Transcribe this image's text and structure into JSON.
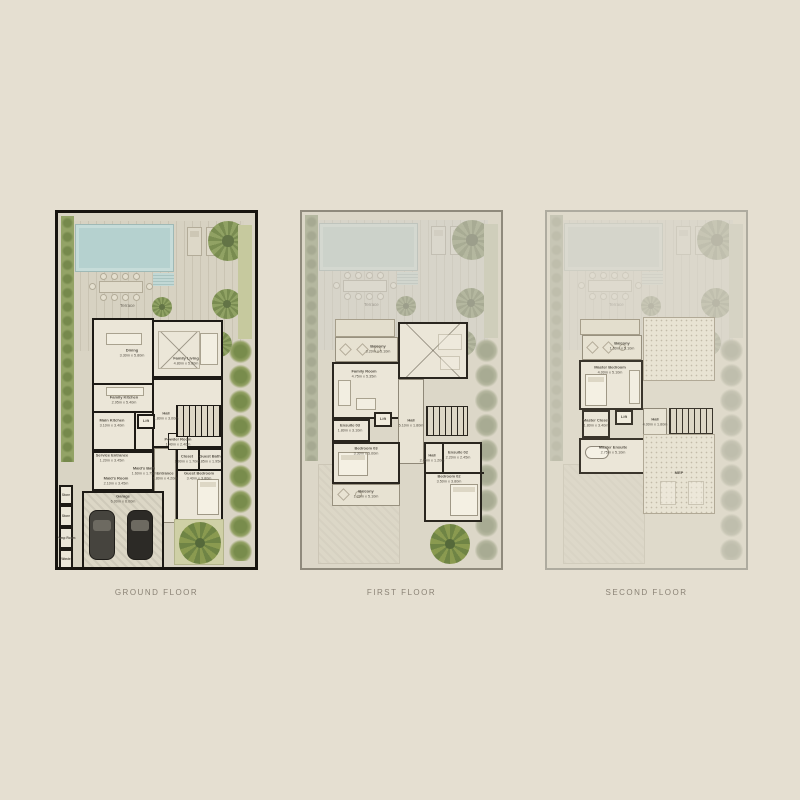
{
  "background": "#e5dfd1",
  "captions": {
    "ground": "GROUND FLOOR",
    "first": "FIRST FLOOR",
    "second": "SECOND FLOOR"
  },
  "shared": {
    "terrace_label": "Terrace"
  },
  "colors": {
    "page_background": "#e5dfd1",
    "pool": "#b5d1cf",
    "hedge_green": "#8ea064",
    "wall_dark": "#1d1a15",
    "caption_text": "#8b8376"
  },
  "plans": {
    "ground": {
      "rooms": {
        "dining": {
          "name": "Dining",
          "dims": "3.30m x 5.80m"
        },
        "familyLiving": {
          "name": "Family Living",
          "dims": "4.80m x 5.80m"
        },
        "familyKitchen": {
          "name": "Family Kitchen",
          "dims": "2.95m x 5.40m"
        },
        "mainKitchen": {
          "name": "Main Kitchen",
          "dims": "3.10m x 3.40m"
        },
        "lift": {
          "name": "Lift"
        },
        "hall": {
          "name": "Hall",
          "dims": "1.80m x 3.00m"
        },
        "powderRoom": {
          "name": "Powder Room",
          "dims": "1.40m x 2.40m"
        },
        "serviceEntrance": {
          "name": "Service Entrance",
          "dims": "1.20m x 3.45m"
        },
        "maidsBath": {
          "name": "Maid's Bath",
          "dims": "1.60m x 1.75m"
        },
        "maidsRoom": {
          "name": "Maid's Room",
          "dims": "2.10m x 3.45m"
        },
        "entrance": {
          "name": "Entrance",
          "dims": "1.80m x 4.20m"
        },
        "closet": {
          "name": "Closet",
          "dims": "1.90m x 1.70m"
        },
        "guestBath": {
          "name": "Guest Bath",
          "dims": "1.85m x 1.95m"
        },
        "guestBedroom": {
          "name": "Guest Bedroom",
          "dims": "3.40m x 3.80m"
        },
        "garage": {
          "name": "Garage",
          "dims": "6.00m x 6.00m"
        },
        "store1": {
          "name": "Store"
        },
        "store2": {
          "name": "Store"
        },
        "pumpRoom": {
          "name": "Pump Room"
        },
        "waste": {
          "name": "Waste"
        }
      }
    },
    "first": {
      "rooms": {
        "balconyTop": {
          "name": "Balcony",
          "dims": "3.20m x 5.10m"
        },
        "familyRoom": {
          "name": "Family Room",
          "dims": "4.75m x 5.35m"
        },
        "ensuite03": {
          "name": "Ensuite 03",
          "dims": "1.80m x 3.10m"
        },
        "lift": {
          "name": "Lift"
        },
        "hall1": {
          "name": "Hall",
          "dims": "5.10m x 1.80m"
        },
        "bedroom03": {
          "name": "Bedroom 03",
          "dims": "3.30m x 5.00m"
        },
        "balconyLower": {
          "name": "Balcony",
          "dims": "1.20m x 5.10m"
        },
        "hall2": {
          "name": "Hall",
          "dims": "2.45m x 1.20m"
        },
        "ensuite02": {
          "name": "Ensuite 02",
          "dims": "2.20m x 2.45m"
        },
        "bedroom02": {
          "name": "Bedroom 02",
          "dims": "3.50m x 3.80m"
        }
      }
    },
    "second": {
      "rooms": {
        "balcony": {
          "name": "Balcony",
          "dims": "1.50m x 5.10m"
        },
        "masterBedroom": {
          "name": "Master Bedroom",
          "dims": "4.00m x 5.10m"
        },
        "masterCloset": {
          "name": "Master Closet",
          "dims": "1.80m x 3.40m"
        },
        "lift": {
          "name": "Lift"
        },
        "hall": {
          "name": "Hall",
          "dims": "4.00m x 1.80m"
        },
        "masterEnsuite": {
          "name": "Master Ensuite",
          "dims": "2.75m x 5.10m"
        },
        "mep": {
          "name": "MEP"
        }
      }
    }
  }
}
